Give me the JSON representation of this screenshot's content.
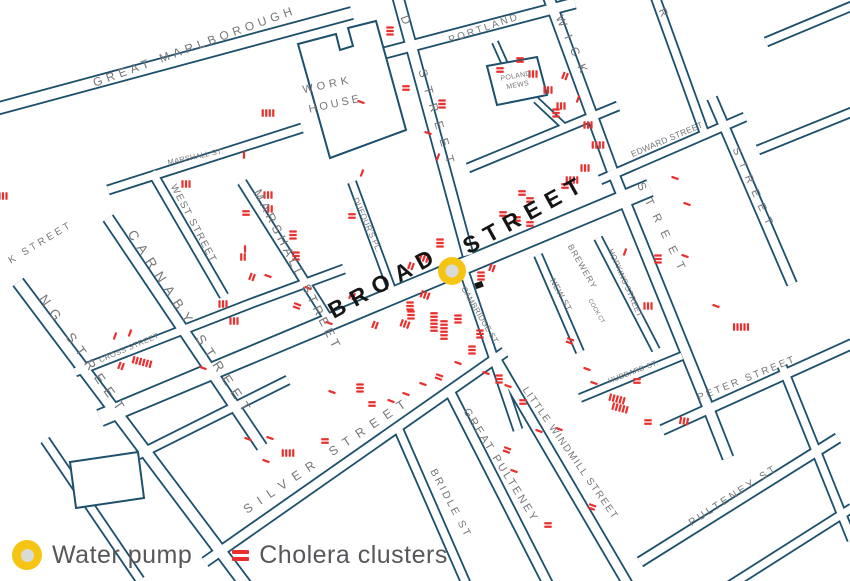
{
  "colors": {
    "street": "#1d506c",
    "cholera": "#e8312e",
    "label_gray": "#75767a",
    "label_dark": "#151515",
    "pump_outer": "#f6c514",
    "pump_inner": "#d9dcd6",
    "background": "#ffffff"
  },
  "legend": {
    "pump_label": "Water pump",
    "cholera_label": "Cholera clusters"
  },
  "pump": {
    "x": 452,
    "y": 271,
    "outer_r": 14,
    "inner_r": 6.5
  },
  "building_marker": {
    "x": 479,
    "y": 285,
    "w": 8,
    "h": 6,
    "angle": -20
  },
  "street_labels": [
    {
      "text": "GREAT MARLBOROUGH",
      "x": 196,
      "y": 50,
      "rot": -20,
      "size": 12,
      "ls": 4.5
    },
    {
      "text": "PORTLAND",
      "x": 485,
      "y": 31,
      "rot": -19,
      "size": 10,
      "ls": 2.5
    },
    {
      "text": "D",
      "x": 403,
      "y": 24,
      "rot": 70,
      "size": 12,
      "ls": 6
    },
    {
      "text": "STREET",
      "x": 434,
      "y": 122,
      "rot": 73,
      "size": 12,
      "ls": 10
    },
    {
      "text": "POLAND",
      "x": 516,
      "y": 78,
      "rot": -10,
      "size": 7,
      "ls": 0.3
    },
    {
      "text": "MEWS",
      "x": 518,
      "y": 87,
      "rot": -10,
      "size": 7,
      "ls": 0.3
    },
    {
      "text": "WORK",
      "x": 328,
      "y": 88,
      "rot": -12,
      "size": 11,
      "ls": 4
    },
    {
      "text": "HOUSE",
      "x": 336,
      "y": 107,
      "rot": -12,
      "size": 11,
      "ls": 3
    },
    {
      "text": "WICK",
      "x": 570,
      "y": 50,
      "rot": 66,
      "size": 12,
      "ls": 10
    },
    {
      "text": "R",
      "x": 660,
      "y": 14,
      "rot": 65,
      "size": 11,
      "ls": 0
    },
    {
      "text": "EDWARD STREET",
      "x": 668,
      "y": 142,
      "rot": -23,
      "size": 8.5,
      "ls": 0.3
    },
    {
      "text": "STREET",
      "x": 660,
      "y": 232,
      "rot": 64,
      "size": 11.5,
      "ls": 10
    },
    {
      "text": "STREET",
      "x": 751,
      "y": 191,
      "rot": 66,
      "size": 11,
      "ls": 8
    },
    {
      "text": "MARSHALL ST.",
      "x": 196,
      "y": 159,
      "rot": -12,
      "size": 7.5,
      "ls": 0.3
    },
    {
      "text": "WEST STREET",
      "x": 191,
      "y": 225,
      "rot": 62,
      "size": 10,
      "ls": 1.5
    },
    {
      "text": "MARSHALL STREET",
      "x": 294,
      "y": 272,
      "rot": 63,
      "size": 12.5,
      "ls": 4
    },
    {
      "text": "DUFOUR'S PL.",
      "x": 365,
      "y": 226,
      "rot": 66,
      "size": 8,
      "ls": 0.3
    },
    {
      "text": "CARNABY STREET",
      "x": 187,
      "y": 326,
      "rot": 57,
      "size": 13.5,
      "ls": 7
    },
    {
      "text": "NG STREET",
      "x": 80,
      "y": 358,
      "rot": 55,
      "size": 13.5,
      "ls": 7.5
    },
    {
      "text": "CROSS STREET",
      "x": 130,
      "y": 350,
      "rot": -23,
      "size": 7.5,
      "ls": 0.5
    },
    {
      "text": "K STREET",
      "x": 42,
      "y": 245,
      "rot": -31,
      "size": 10,
      "ls": 3
    },
    {
      "text": "BROAD",
      "x": 388,
      "y": 289,
      "rot": -29,
      "size": 23,
      "ls": 8,
      "color": "dark"
    },
    {
      "text": "STREET",
      "x": 529,
      "y": 221,
      "rot": -29,
      "size": 23,
      "ls": 8,
      "color": "dark"
    },
    {
      "text": "CAMBRIDGE ST.",
      "x": 478,
      "y": 317,
      "rot": 59,
      "size": 8,
      "ls": 0.3
    },
    {
      "text": "BREWERY",
      "x": 580,
      "y": 268,
      "rot": 60,
      "size": 8.5,
      "ls": 1
    },
    {
      "text": "NEW ST.",
      "x": 559,
      "y": 297,
      "rot": 61,
      "size": 8.5,
      "ls": 0.5
    },
    {
      "text": "COCK CT",
      "x": 595,
      "y": 312,
      "rot": 60,
      "size": 6,
      "ls": 0
    },
    {
      "text": "HOPKINS STREET",
      "x": 623,
      "y": 284,
      "rot": 66,
      "size": 8,
      "ls": 0.3
    },
    {
      "text": "HUBBARD ST.",
      "x": 634,
      "y": 374,
      "rot": -21,
      "size": 7.5,
      "ls": 0.3
    },
    {
      "text": "PETER STREET",
      "x": 748,
      "y": 381,
      "rot": -22,
      "size": 10,
      "ls": 2.5
    },
    {
      "text": "SILVER STREET",
      "x": 330,
      "y": 458,
      "rot": -34,
      "size": 12.5,
      "ls": 8
    },
    {
      "text": "BRIDLE ST",
      "x": 448,
      "y": 505,
      "rot": 62,
      "size": 10.5,
      "ls": 2.5
    },
    {
      "text": "GREAT PULTENEY",
      "x": 498,
      "y": 467,
      "rot": 58,
      "size": 11,
      "ls": 2.5
    },
    {
      "text": "LITTLE WINDMILL STREET",
      "x": 568,
      "y": 455,
      "rot": 55,
      "size": 10,
      "ls": 1.5
    },
    {
      "text": "PULTENEY ST",
      "x": 735,
      "y": 498,
      "rot": -33,
      "size": 10.5,
      "ls": 3
    }
  ],
  "clusters": [
    [
      268,
      113,
      4,
      0
    ],
    [
      186,
      184,
      3,
      0
    ],
    [
      244,
      155,
      1,
      0
    ],
    [
      3,
      196,
      3,
      0
    ],
    [
      390,
      31,
      3,
      90
    ],
    [
      406,
      88,
      2,
      90
    ],
    [
      361,
      102,
      1,
      110
    ],
    [
      442,
      104,
      3,
      90
    ],
    [
      428,
      133,
      1,
      110
    ],
    [
      438,
      157,
      1,
      20
    ],
    [
      500,
      70,
      2,
      90
    ],
    [
      520,
      60,
      2,
      90
    ],
    [
      533,
      74,
      3,
      0
    ],
    [
      548,
      90,
      3,
      0
    ],
    [
      561,
      106,
      3,
      0
    ],
    [
      565,
      76,
      2,
      20
    ],
    [
      578,
      99,
      1,
      20
    ],
    [
      556,
      113,
      3,
      90
    ],
    [
      588,
      125,
      3,
      0
    ],
    [
      598,
      145,
      4,
      0
    ],
    [
      572,
      180,
      4,
      0
    ],
    [
      585,
      168,
      3,
      0
    ],
    [
      352,
      216,
      2,
      90
    ],
    [
      362,
      173,
      1,
      20
    ],
    [
      411,
      266,
      2,
      20
    ],
    [
      424,
      258,
      3,
      20
    ],
    [
      440,
      243,
      3,
      90
    ],
    [
      503,
      214,
      2,
      90
    ],
    [
      517,
      219,
      2,
      90
    ],
    [
      530,
      224,
      2,
      90
    ],
    [
      522,
      193,
      2,
      90
    ],
    [
      530,
      200,
      2,
      90
    ],
    [
      565,
      186,
      2,
      90
    ],
    [
      481,
      276,
      3,
      90
    ],
    [
      492,
      268,
      2,
      20
    ],
    [
      410,
      306,
      3,
      90
    ],
    [
      411,
      315,
      3,
      90
    ],
    [
      425,
      295,
      3,
      20
    ],
    [
      434,
      322,
      6,
      90
    ],
    [
      444,
      330,
      6,
      90
    ],
    [
      405,
      324,
      3,
      20
    ],
    [
      375,
      325,
      2,
      20
    ],
    [
      352,
      296,
      2,
      20
    ],
    [
      458,
      319,
      3,
      90
    ],
    [
      480,
      334,
      3,
      90
    ],
    [
      472,
      350,
      3,
      90
    ],
    [
      246,
      213,
      2,
      90
    ],
    [
      268,
      195,
      3,
      0
    ],
    [
      270,
      209,
      2,
      0
    ],
    [
      293,
      235,
      3,
      90
    ],
    [
      296,
      256,
      3,
      90
    ],
    [
      243,
      257,
      2,
      0
    ],
    [
      245,
      249,
      1,
      0
    ],
    [
      252,
      277,
      2,
      20
    ],
    [
      268,
      276,
      1,
      110
    ],
    [
      223,
      304,
      3,
      0
    ],
    [
      234,
      321,
      3,
      0
    ],
    [
      297,
      306,
      2,
      110
    ],
    [
      329,
      323,
      1,
      110
    ],
    [
      308,
      288,
      1,
      110
    ],
    [
      115,
      336,
      1,
      20
    ],
    [
      142,
      362,
      6,
      15
    ],
    [
      121,
      366,
      2,
      20
    ],
    [
      203,
      368,
      1,
      110
    ],
    [
      130,
      333,
      1,
      20
    ],
    [
      248,
      439,
      1,
      110
    ],
    [
      270,
      438,
      1,
      110
    ],
    [
      266,
      461,
      1,
      110
    ],
    [
      288,
      453,
      4,
      0
    ],
    [
      325,
      441,
      2,
      90
    ],
    [
      675,
      178,
      1,
      110
    ],
    [
      687,
      204,
      1,
      110
    ],
    [
      685,
      256,
      1,
      110
    ],
    [
      658,
      259,
      3,
      90
    ],
    [
      625,
      252,
      1,
      20
    ],
    [
      648,
      306,
      3,
      0
    ],
    [
      716,
      306,
      1,
      110
    ],
    [
      741,
      327,
      5,
      0
    ],
    [
      570,
      341,
      2,
      110
    ],
    [
      587,
      369,
      1,
      110
    ],
    [
      594,
      383,
      1,
      110
    ],
    [
      617,
      399,
      5,
      15
    ],
    [
      620,
      408,
      5,
      15
    ],
    [
      637,
      381,
      2,
      90
    ],
    [
      648,
      422,
      2,
      90
    ],
    [
      684,
      421,
      3,
      10
    ],
    [
      360,
      388,
      3,
      90
    ],
    [
      332,
      392,
      1,
      110
    ],
    [
      372,
      404,
      2,
      90
    ],
    [
      391,
      401,
      1,
      110
    ],
    [
      406,
      394,
      1,
      110
    ],
    [
      423,
      384,
      1,
      110
    ],
    [
      439,
      377,
      2,
      110
    ],
    [
      458,
      363,
      1,
      110
    ],
    [
      486,
      373,
      1,
      110
    ],
    [
      499,
      379,
      3,
      90
    ],
    [
      508,
      386,
      1,
      110
    ],
    [
      523,
      402,
      2,
      90
    ],
    [
      539,
      431,
      1,
      110
    ],
    [
      559,
      429,
      1,
      110
    ],
    [
      507,
      450,
      2,
      110
    ],
    [
      514,
      471,
      1,
      110
    ],
    [
      592,
      507,
      2,
      110
    ],
    [
      548,
      525,
      2,
      90
    ]
  ]
}
